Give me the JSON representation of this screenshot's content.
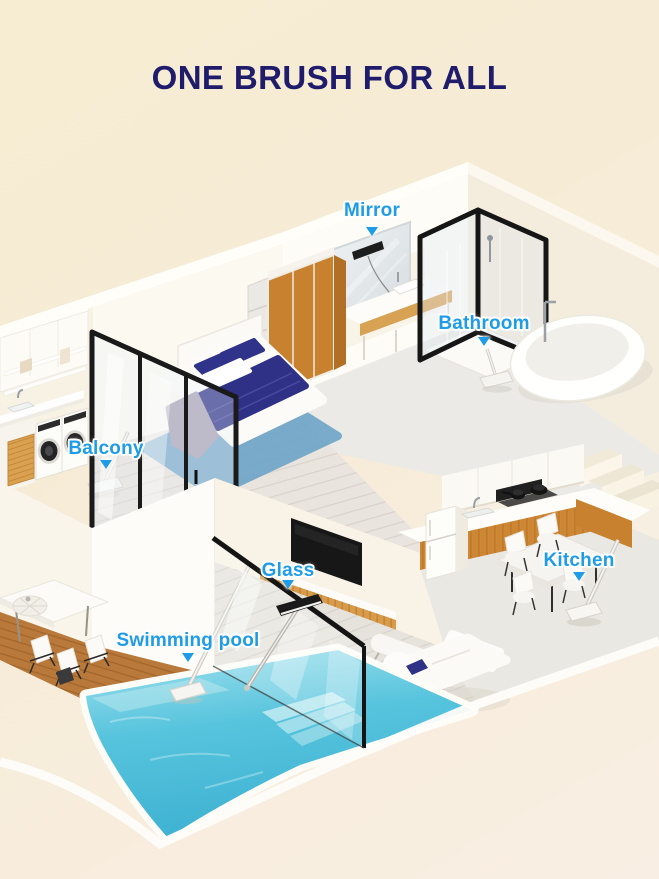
{
  "title": "ONE BRUSH FOR ALL",
  "callouts": {
    "mirror": "Mirror",
    "bathroom": "Bathroom",
    "balcony": "Balcony",
    "glass": "Glass",
    "swimming_pool": "Swimming pool",
    "kitchen": "Kitchen"
  },
  "icons": {
    "callout_pointer": "down-triangle"
  },
  "colors": {
    "background_top_left": "#f7edd2",
    "background_bottom_right": "#f9eee3",
    "title_text": "#1f1c6b",
    "callout_text": "#1f9ce8",
    "pool_water": "#52c2dc",
    "cabinet_wood": "#cd8634",
    "deck_wood": "#b9793b",
    "bedding_navy": "#2f3186",
    "frame_black": "#1a1a1a"
  }
}
